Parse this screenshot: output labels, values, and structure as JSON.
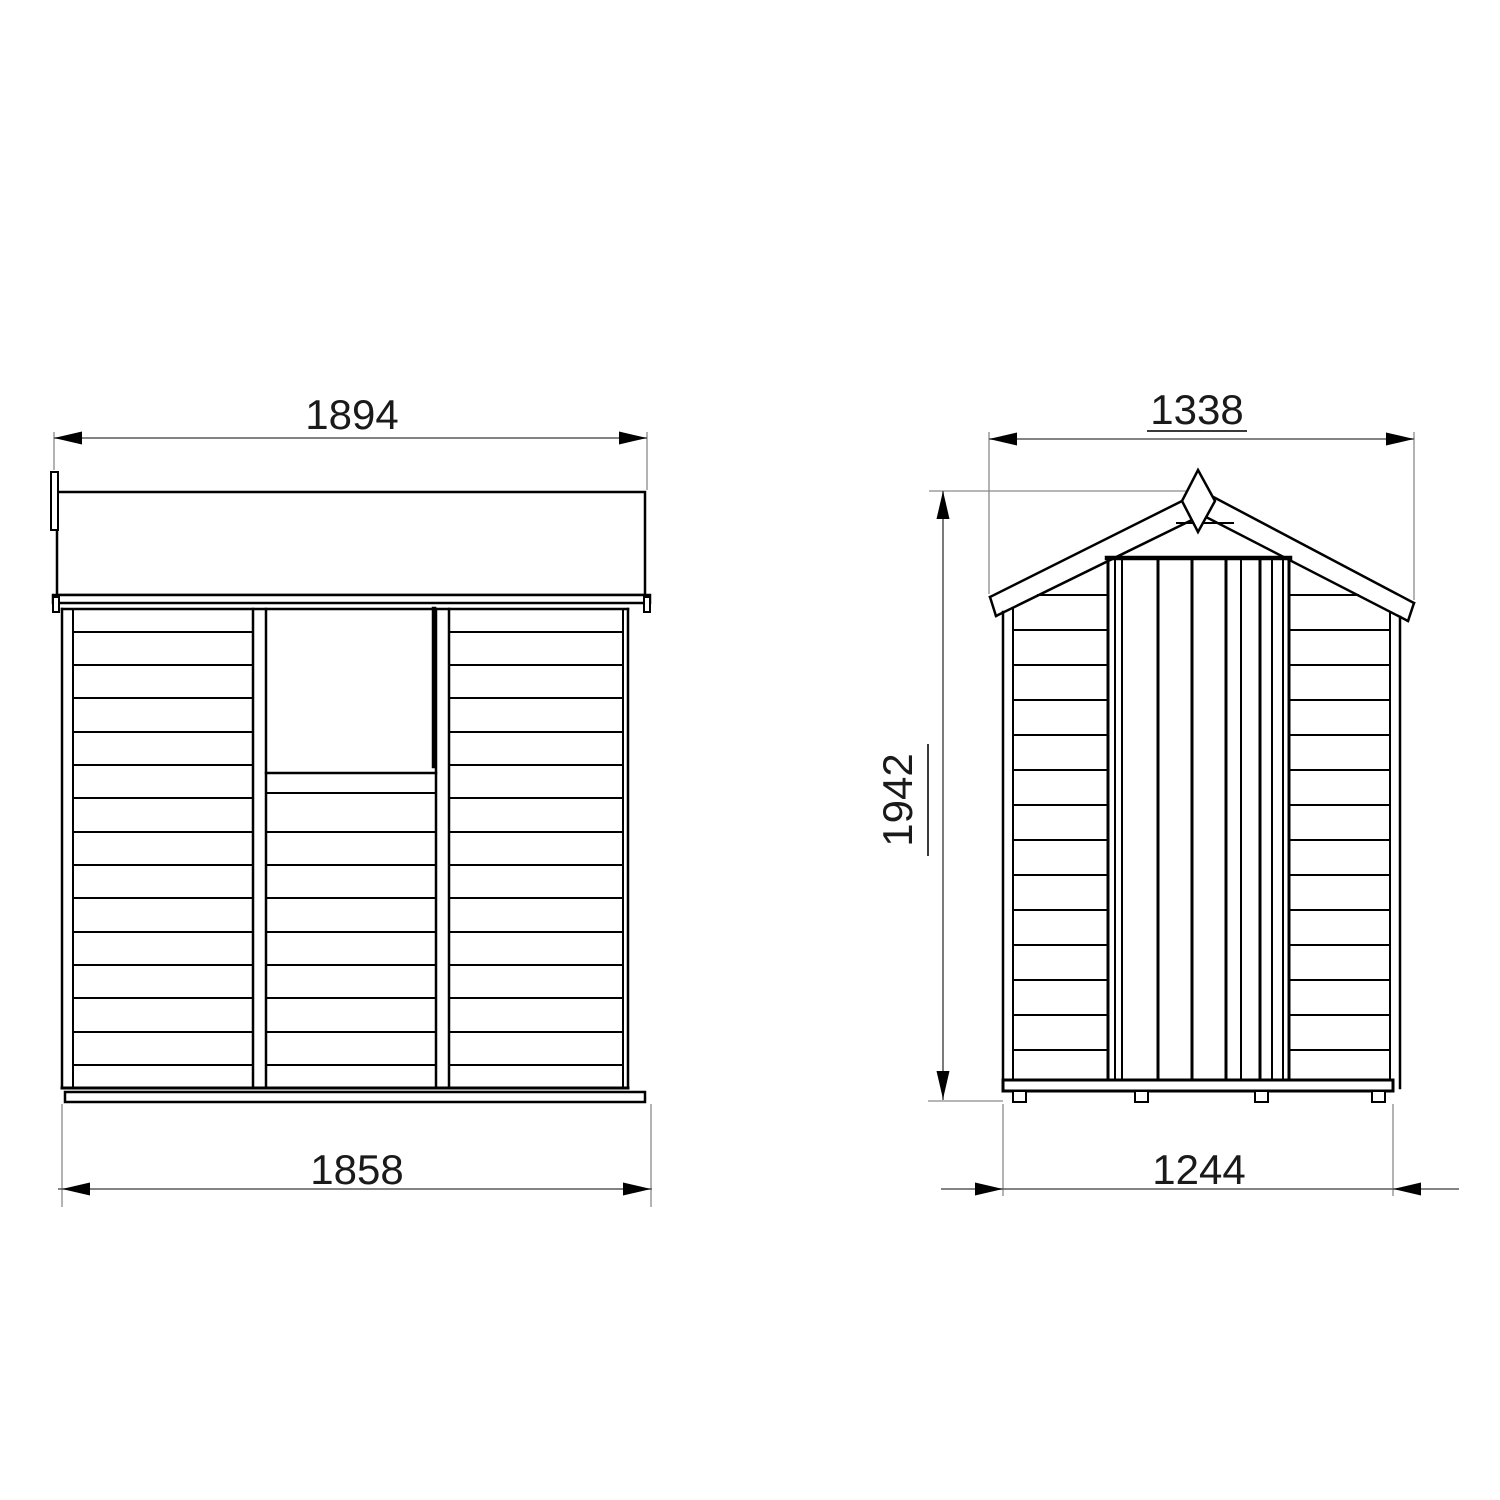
{
  "diagram": {
    "subject": "garden shed two-view dimensioned elevation drawing",
    "dimensions": {
      "side_top_width": "1894",
      "side_base_width": "1858",
      "front_roof_width": "1338",
      "front_ridge_height": "1942",
      "front_base_width": "1244"
    },
    "colors": {
      "background": "#ffffff",
      "geometry_line": "#000000",
      "dimension_line": "#5a5a5a",
      "extension_line": "#8a8a8a",
      "text": "#1a1a1a"
    }
  }
}
